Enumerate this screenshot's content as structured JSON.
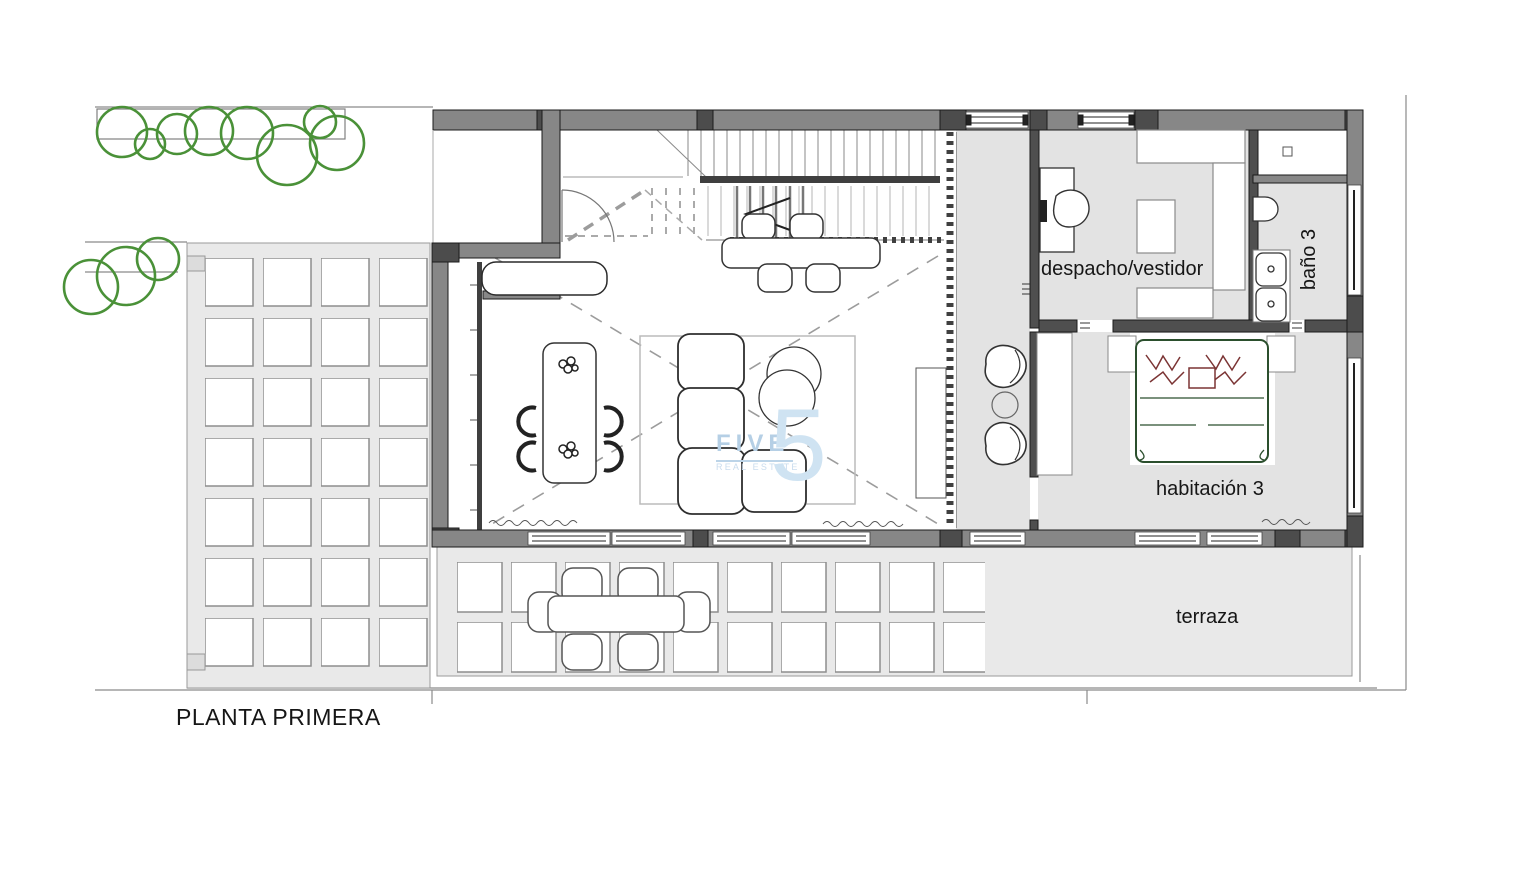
{
  "plan_title": "PLANTA PRIMERA",
  "labels": {
    "despacho": "despacho/vestidor",
    "bano": "baño 3",
    "habitacion": "habitación 3",
    "terraza": "terraza"
  },
  "watermark": {
    "brand": "FIVE",
    "tagline": "REAL ESTATE",
    "numeral": "5"
  },
  "rooms": [
    "despacho/vestidor",
    "baño 3",
    "habitación 3",
    "terraza"
  ],
  "colors": {
    "wall": "#878787",
    "wall_joint": "#4c4c4c",
    "partition": "#4f4f4f",
    "room_floor": "#e3e3e3",
    "terrace_floor": "#e9e9e9",
    "tile": "#ffffff",
    "tree_green": "#4a9138",
    "bed_outline_green": "#2b4f2d",
    "pillow_red": "#7b3434",
    "watermark_blue": "#b5cfe5",
    "text": "#161616"
  }
}
